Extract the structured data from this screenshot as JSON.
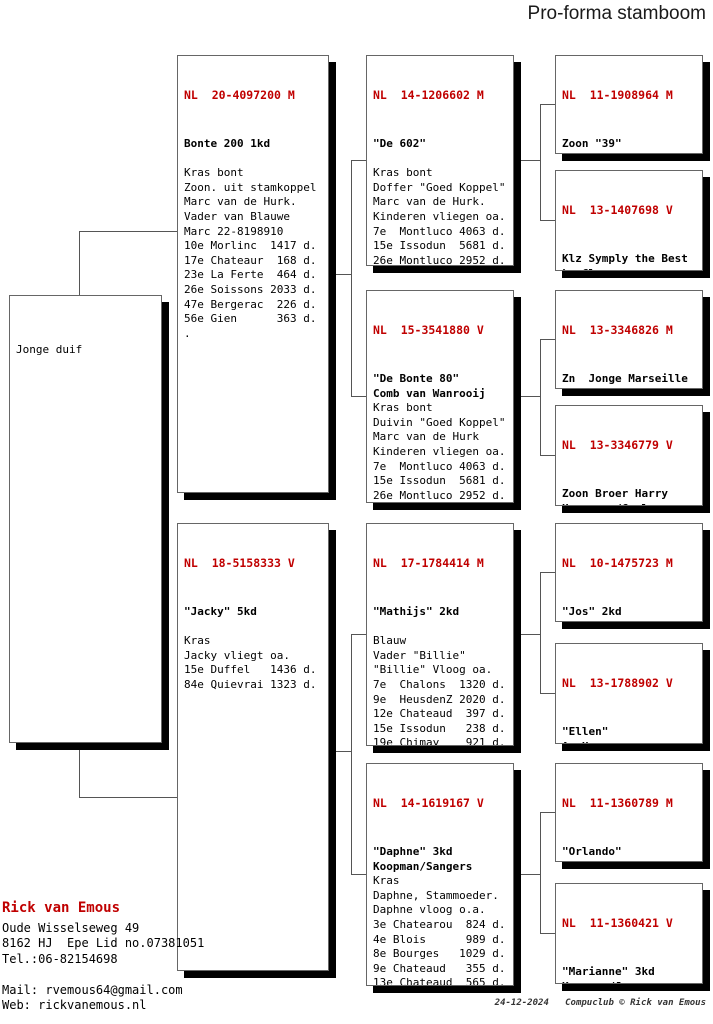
{
  "title": "Pro-forma stamboom",
  "accent_color": "#c00000",
  "boxes": {
    "subject": {
      "header": "",
      "lines": [
        " ",
        "Jonge duif"
      ]
    },
    "sire": {
      "header": "NL  20-4097200 M",
      "lines": [
        "Bonte 200 1kd",
        " ",
        "Kras bont",
        "Zoon. uit stamkoppel",
        "Marc van de Hurk.",
        "Vader van Blauwe",
        "Marc 22-8198910",
        "10e Morlinc  1417 d.",
        "17e Chateaur  168 d.",
        "23e La Ferte  464 d.",
        "26e Soissons 2033 d.",
        "47e Bergerac  226 d.",
        "56e Gien      363 d.",
        "."
      ]
    },
    "dam": {
      "header": "NL  18-5158333 V",
      "lines": [
        "\"Jacky\" 5kd",
        " ",
        "Kras",
        "Jacky vliegt oa.",
        "15e Duffel   1436 d.",
        "84e Quievrai 1323 d."
      ]
    },
    "g1": {
      "header": "NL  14-1206602 M",
      "lines": [
        "\"De 602\"",
        " ",
        "Kras bont",
        "Doffer \"Goed Koppel\"",
        "Marc van de Hurk.",
        "Kinderen vliegen oa.",
        "7e  Montluco 4063 d.",
        "15e Issodun  5681 d.",
        "26e Montluco 2952 d.",
        "32e Chateaur 2349 d.",
        "57e La Soute 2468 d.",
        "57e Montluco 2731 d.",
        "75e La Soute 2108 d."
      ]
    },
    "g2": {
      "header": "NL  15-3541880 V",
      "lines": [
        "\"De Bonte 80\"",
        "Comb van Wanrooij",
        "Kras bont",
        "Duivin \"Goed Koppel\"",
        "Marc van de Hurk",
        "Kinderen vliegen oa.",
        "7e  Montluco 4063 d.",
        "15e Issodun  5681 d.",
        "26e Montluco 2952 d.",
        "32e Chateaur 2349 d.",
        "57e La Soute 2468 d.",
        "57e Montluco 2731 d.",
        "75e La Soute 2108 d."
      ]
    },
    "g3": {
      "header": "NL  17-1784414 M",
      "lines": [
        "\"Mathijs\" 2kd",
        " ",
        "Blauw",
        "Vader \"Billie\"",
        "\"Billie\" Vloog oa.",
        "7e  Chalons  1320 d.",
        "9e  HeusdenZ 2020 d.",
        "12e Chateaud  397 d.",
        "15e Issodun   238 d.",
        "19e Chimay    921 d.",
        "20e Chateauro 184 d.",
        "25e Qiuevrai 2206 d.",
        "25e Bourges   510 d."
      ]
    },
    "g4": {
      "header": "NL  14-1619167 V",
      "lines": [
        "\"Daphne\" 3kd",
        "Koopman/Sangers",
        "Kras",
        "Daphne, Stammoeder.",
        "Daphne vloog o.a.",
        "3e Chatearou  824 d.",
        "4e Blois      989 d.",
        "8e Bourges   1029 d.",
        "9e Chateaud   355 d.",
        "13e Chateaud  565 d.",
        "20e Chateaud  540 d.",
        "47e Sezanne  1253 d.",
        "Grootmoeder Wustje,"
      ]
    },
    "gg1": {
      "header": "NL  11-1908964 M",
      "lines": [
        "Zoon \"39\"",
        "J Visser",
        "Kras bont",
        "De \"39\"was een",
        "Superdoffer, 34e Nat"
      ]
    },
    "gg2": {
      "header": "NL  13-1407698 V",
      "lines": [
        "Klz Symply the Best",
        "L. Claessens",
        "Kras bont",
        "Uit Kleindochter",
        "Jonge supercrack en"
      ]
    },
    "gg3": {
      "header": "NL  13-3346826 M",
      "lines": [
        "Zn  Jonge Marseille",
        "Comb van Wanrooij",
        "Blauw",
        "Zn Jonge Marseile",
        "Marcel Aelbtrecht."
      ]
    },
    "gg4": {
      "header": "NL  13-3346779 V",
      "lines": [
        "Zoon Broer Harry",
        "Hooymans/Cools",
        "Kras",
        "6e NPO La-souteraine",
        "4239 d."
      ]
    },
    "gg5": {
      "header": "NL  10-1475723 M",
      "lines": [
        "\"Jos\" 2kd",
        "Koopman",
        "Kras",
        "Vader van 200 en 201",
        "Gr vader van de \"10\""
      ]
    },
    "gg6": {
      "header": "NL  13-1788902 V",
      "lines": [
        "\"Ellen\"",
        "A. Hup",
        "Donker kras",
        "Half zus Champ 808"
      ]
    },
    "gg7": {
      "header": "NL  11-1360789 M",
      "lines": [
        "\"Orlando\"",
        "Sangers/Nieuwenhuis",
        "Kras",
        "\"Orlando\" vloog:",
        "Bourges  18 - 430 d."
      ]
    },
    "gg8": {
      "header": "NL  11-1360421 V",
      "lines": [
        "\"Marianne\" 3kd",
        "Koopman/Janssen",
        "Kras",
        "Super Kweekduivin,",
        "moeder van oa."
      ]
    }
  },
  "contact": {
    "name": "Rick van Emous",
    "lines": [
      "Oude Wisselseweg 49",
      "8162 HJ  Epe Lid no.07381051",
      "Tel.:06-82154698",
      " ",
      "Mail: rvemous64@gmail.com",
      "Web: rickvanemous.nl"
    ]
  },
  "footer": {
    "text": "24-12-2024   Compuclub © Rick van Emous"
  }
}
